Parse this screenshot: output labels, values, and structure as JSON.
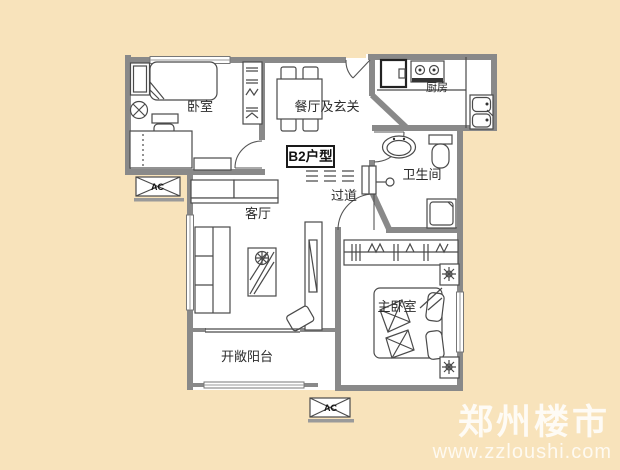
{
  "page": {
    "background_color": "#f8e3bb"
  },
  "floorplan": {
    "unit_label": "B2户型",
    "rooms": [
      {
        "id": "bedroom",
        "label": "卧室"
      },
      {
        "id": "dining-foyer",
        "label": "餐厅及玄关"
      },
      {
        "id": "kitchen",
        "label": "厨房"
      },
      {
        "id": "bathroom",
        "label": "卫生间"
      },
      {
        "id": "corridor",
        "label": "过道"
      },
      {
        "id": "living-room",
        "label": "客厅"
      },
      {
        "id": "master-bedroom",
        "label": "主卧室"
      },
      {
        "id": "balcony",
        "label": "开敞阳台"
      }
    ],
    "ac_units": [
      {
        "label": "AC"
      },
      {
        "label": "AC"
      }
    ],
    "colors": {
      "background": "#f8e3bb",
      "floor": "#ffffff",
      "wall": "#898989",
      "furniture_line": "#4a4a4a",
      "label_text": "#2b2b2b"
    }
  },
  "watermark": {
    "site_name": "郑州楼市",
    "site_url": "www.zzloushi.com",
    "color": "#ffffff"
  }
}
